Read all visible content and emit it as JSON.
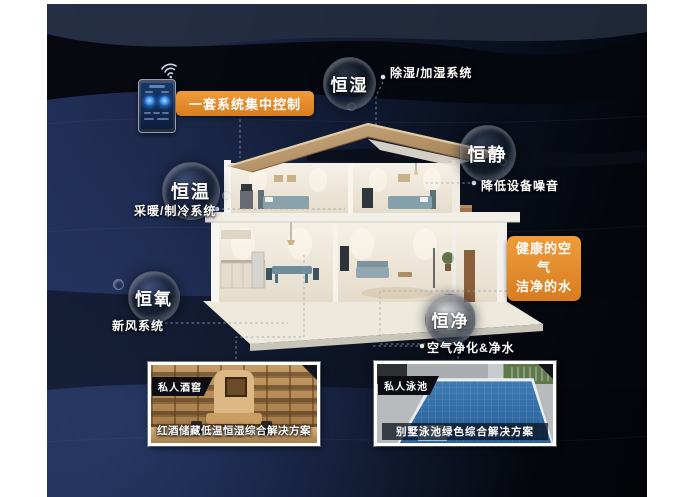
{
  "theme": {
    "accent_orange": "#e0862a",
    "canvas_navy": "#1d2a4a",
    "canvas_black": "#04060b",
    "label_text": "#ffffff"
  },
  "control_panel": {
    "label": "一套系统集中控制",
    "phone_icon": "smart-home-control-phone",
    "wifi_icon": "wifi-signal"
  },
  "bubbles": [
    {
      "label": "恒湿",
      "desc": "除湿/加湿系统"
    },
    {
      "label": "恒静",
      "desc": "降低设备噪音"
    },
    {
      "label": "恒温",
      "desc": "采暖/制冷系统"
    },
    {
      "label": "恒氧",
      "desc": "新风系统"
    },
    {
      "label": "恒净",
      "desc": "空气净化&净水"
    }
  ],
  "highlight": {
    "line1": "健康的空气",
    "line2": "洁净的水"
  },
  "cards": [
    {
      "tag": "私人酒窖",
      "caption": "红酒储藏低温恒湿综合解决方案"
    },
    {
      "tag": "私人泳池",
      "caption": "别墅泳池绿色综合解决方案"
    }
  ]
}
